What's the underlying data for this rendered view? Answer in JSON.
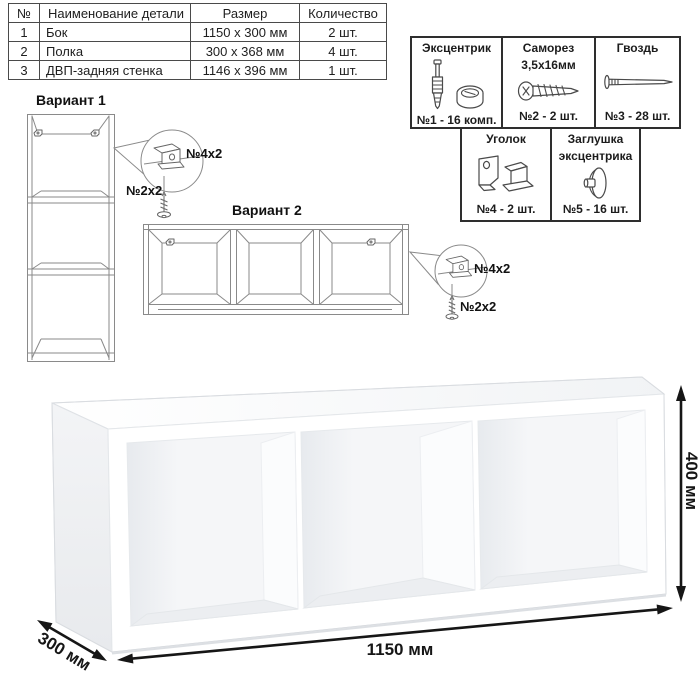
{
  "parts_table": {
    "headers": [
      "№",
      "Наименование детали",
      "Размер",
      "Количество"
    ],
    "rows": [
      [
        "1",
        "Бок",
        "1150 х 300 мм",
        "2 шт."
      ],
      [
        "2",
        "Полка",
        "300 х 368 мм",
        "4 шт."
      ],
      [
        "3",
        "ДВП-задняя стенка",
        "1146 х 396 мм",
        "1 шт."
      ]
    ]
  },
  "hardware": {
    "cells": [
      {
        "name": "Эксцентрик",
        "name2": "",
        "count": "№1 - 16 комп.",
        "icon": "eccentric-and-cam-icon"
      },
      {
        "name": "Саморез",
        "name2": "3,5х16мм",
        "count": "№2 - 2 шт.",
        "icon": "screw-icon"
      },
      {
        "name": "Гвоздь",
        "name2": "",
        "count": "№3 - 28 шт.",
        "icon": "nail-icon"
      },
      {
        "name": "Уголок",
        "name2": "",
        "count": "№4 - 2 шт.",
        "icon": "corner-bracket-icon"
      },
      {
        "name": "Заглушка",
        "name2": "эксцентрика",
        "count": "№5 - 16 шт.",
        "icon": "cam-cap-icon"
      }
    ]
  },
  "variants": {
    "v1": {
      "title": "Вариант 1",
      "bracket_label": "№4х2",
      "screw_label": "№2х2",
      "detail_icons": [
        "corner-bracket-icon",
        "screw-icon"
      ]
    },
    "v2": {
      "title": "Вариант 2",
      "bracket_label": "№4х2",
      "screw_label": "№2х2",
      "detail_icons": [
        "corner-bracket-icon",
        "screw-icon"
      ]
    }
  },
  "dimensions": {
    "width": "1150 мм",
    "height": "400 мм",
    "depth": "300 мм"
  },
  "colors": {
    "wireframe_gray": "#8a8a8a",
    "border_dark": "#2e2e2e",
    "dimension_black": "#161616",
    "shade_light": "#eef0f3"
  }
}
